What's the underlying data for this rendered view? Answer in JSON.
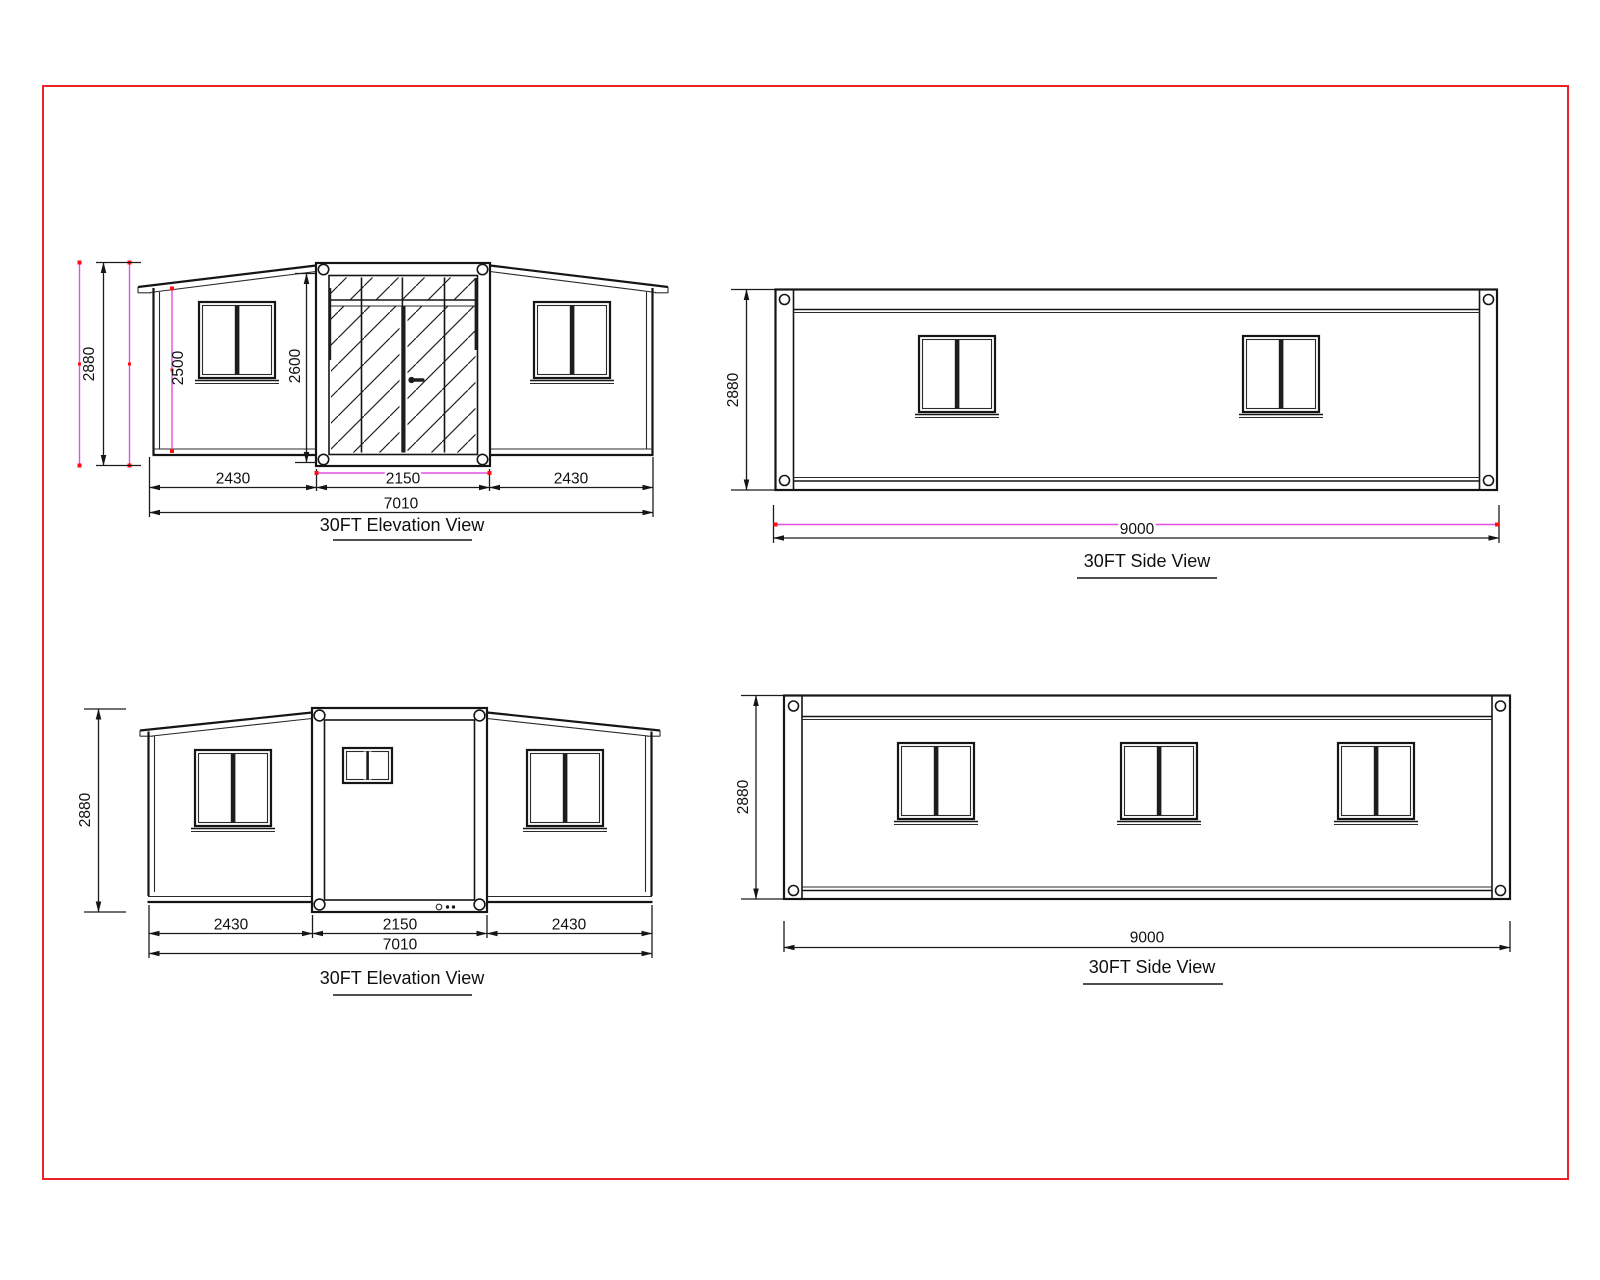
{
  "colors": {
    "frame_red": "#ec2227",
    "dim_magenta": "#e151e1",
    "dim_red_tick": "#ff1010",
    "line": "#151515",
    "paper": "#ffffff"
  },
  "views": {
    "front_elevation": {
      "label": "30FT Elevation View",
      "dims": {
        "overall_height": "2880",
        "wing_height": "2500",
        "door_height": "2600",
        "left_width": "2430",
        "center_width": "2150",
        "right_width": "2430",
        "overall_width": "7010"
      }
    },
    "top_side_view": {
      "label": "30FT Side View",
      "dims": {
        "height": "2880",
        "length": "9000"
      }
    },
    "rear_elevation": {
      "label": "30FT Elevation View",
      "dims": {
        "overall_height": "2880",
        "left_width": "2430",
        "center_width": "2150",
        "right_width": "2430",
        "overall_width": "7010"
      }
    },
    "bottom_side_view": {
      "label": "30FT Side View",
      "dims": {
        "height": "2880",
        "length": "9000"
      }
    }
  }
}
